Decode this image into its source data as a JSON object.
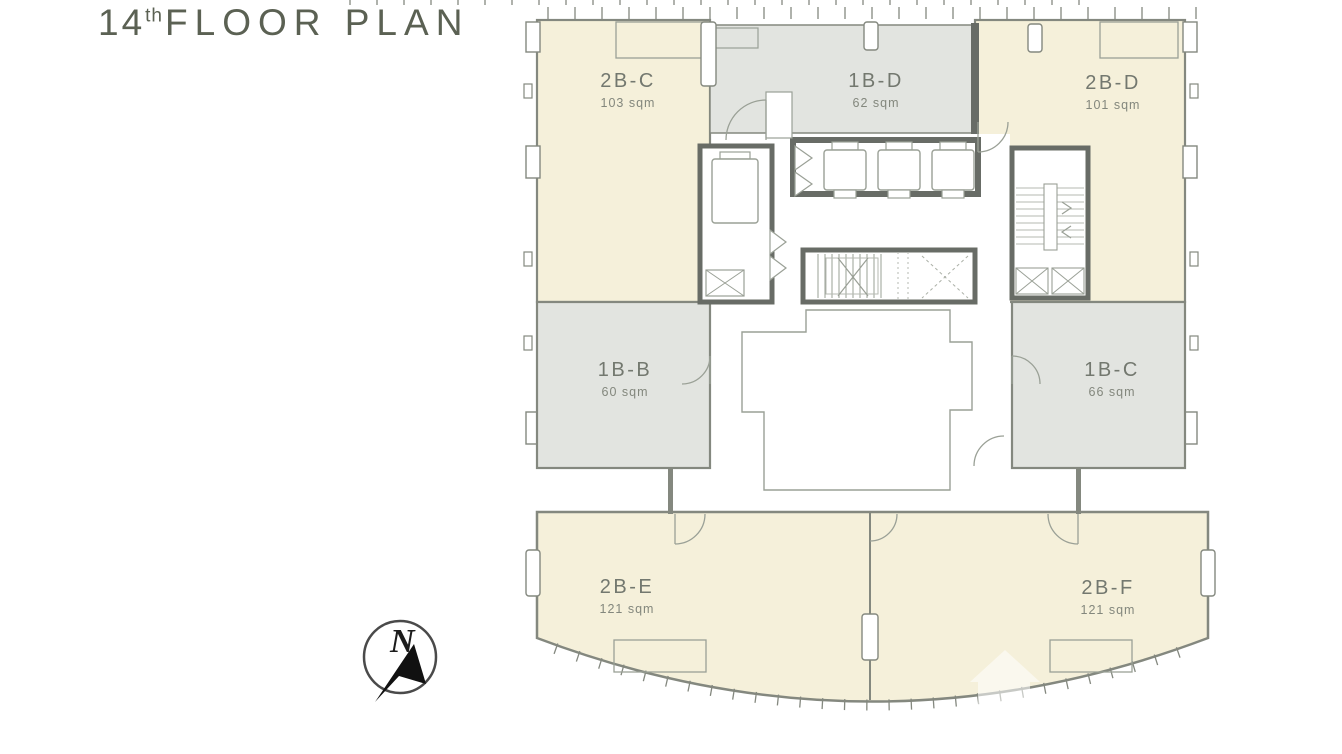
{
  "title": {
    "number": "14",
    "ordinal": "th",
    "text": "FLOOR PLAN"
  },
  "compass": {
    "label": "N"
  },
  "units": [
    {
      "key": "2b-c",
      "name": "2B-C",
      "area": "103 sqm",
      "fill": "cream"
    },
    {
      "key": "1b-d",
      "name": "1B-D",
      "area": "62 sqm",
      "fill": "gray"
    },
    {
      "key": "2b-d",
      "name": "2B-D",
      "area": "101 sqm",
      "fill": "cream"
    },
    {
      "key": "1b-b",
      "name": "1B-B",
      "area": "60 sqm",
      "fill": "gray"
    },
    {
      "key": "1b-c",
      "name": "1B-C",
      "area": "66 sqm",
      "fill": "gray"
    },
    {
      "key": "2b-e",
      "name": "2B-E",
      "area": "121 sqm",
      "fill": "cream"
    },
    {
      "key": "2b-f",
      "name": "2B-F",
      "area": "121 sqm",
      "fill": "cream"
    }
  ],
  "colors": {
    "unit_cream": "#f5f0da",
    "unit_gray": "#e2e4e0",
    "outer_wall": "#84887f",
    "core_wall": "#686c66",
    "thin_line": "#9aa096",
    "label_text": "#73786f",
    "title_text": "#5b6153"
  }
}
